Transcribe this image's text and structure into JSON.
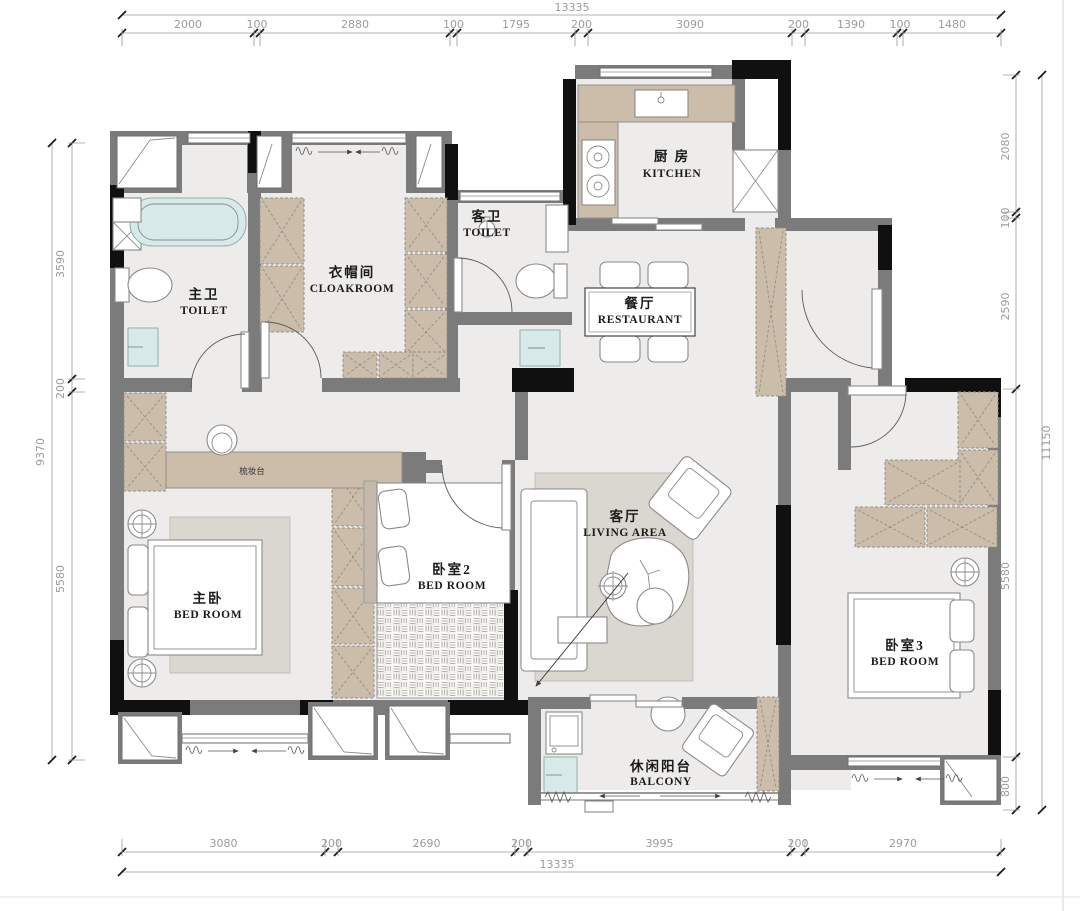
{
  "document": {
    "type": "apartment-floor-plan"
  },
  "rooms": {
    "kitchen": {
      "zh": "厨 房",
      "en": "KITCHEN"
    },
    "guest_toilet": {
      "zh": "客卫",
      "en": "TOILET"
    },
    "master_toilet": {
      "zh": "主卫",
      "en": "TOILET"
    },
    "cloakroom": {
      "zh": "衣帽间",
      "en": "CLOAKROOM"
    },
    "dining": {
      "zh": "餐厅",
      "en": "RESTAURANT"
    },
    "bedroom2": {
      "zh": "卧室2",
      "en": "BED ROOM"
    },
    "master_bedroom": {
      "zh": "主卧",
      "en": "BED ROOM"
    },
    "living": {
      "zh": "客厅",
      "en": "LIVING AREA"
    },
    "bedroom3": {
      "zh": "卧室3",
      "en": "BED ROOM"
    },
    "balcony": {
      "zh": "休闲阳台",
      "en": "BALCONY"
    },
    "dressing_table": {
      "zh": "梳妆台"
    }
  },
  "dimensions": {
    "top": {
      "total": "13335",
      "segments": [
        "2000",
        "100",
        "2880",
        "100",
        "1795",
        "200",
        "3090",
        "200",
        "1390",
        "100",
        "1480"
      ]
    },
    "bottom": {
      "total": "13335",
      "segments": [
        "3080",
        "200",
        "2690",
        "200",
        "3995",
        "200",
        "2970"
      ]
    },
    "left": {
      "total": "9370",
      "segments": [
        "3590",
        "200",
        "5580"
      ]
    },
    "right": {
      "total": "11150",
      "segments": [
        "2080",
        "100",
        "2590",
        "5580",
        "800"
      ]
    }
  },
  "colors": {
    "wall": "#7b7b7b",
    "wall_dark": "#101010",
    "floor": "#edecea",
    "cabinet": "#cbbda9",
    "water": "#d8e9e9",
    "rug": "#dad7d1"
  }
}
